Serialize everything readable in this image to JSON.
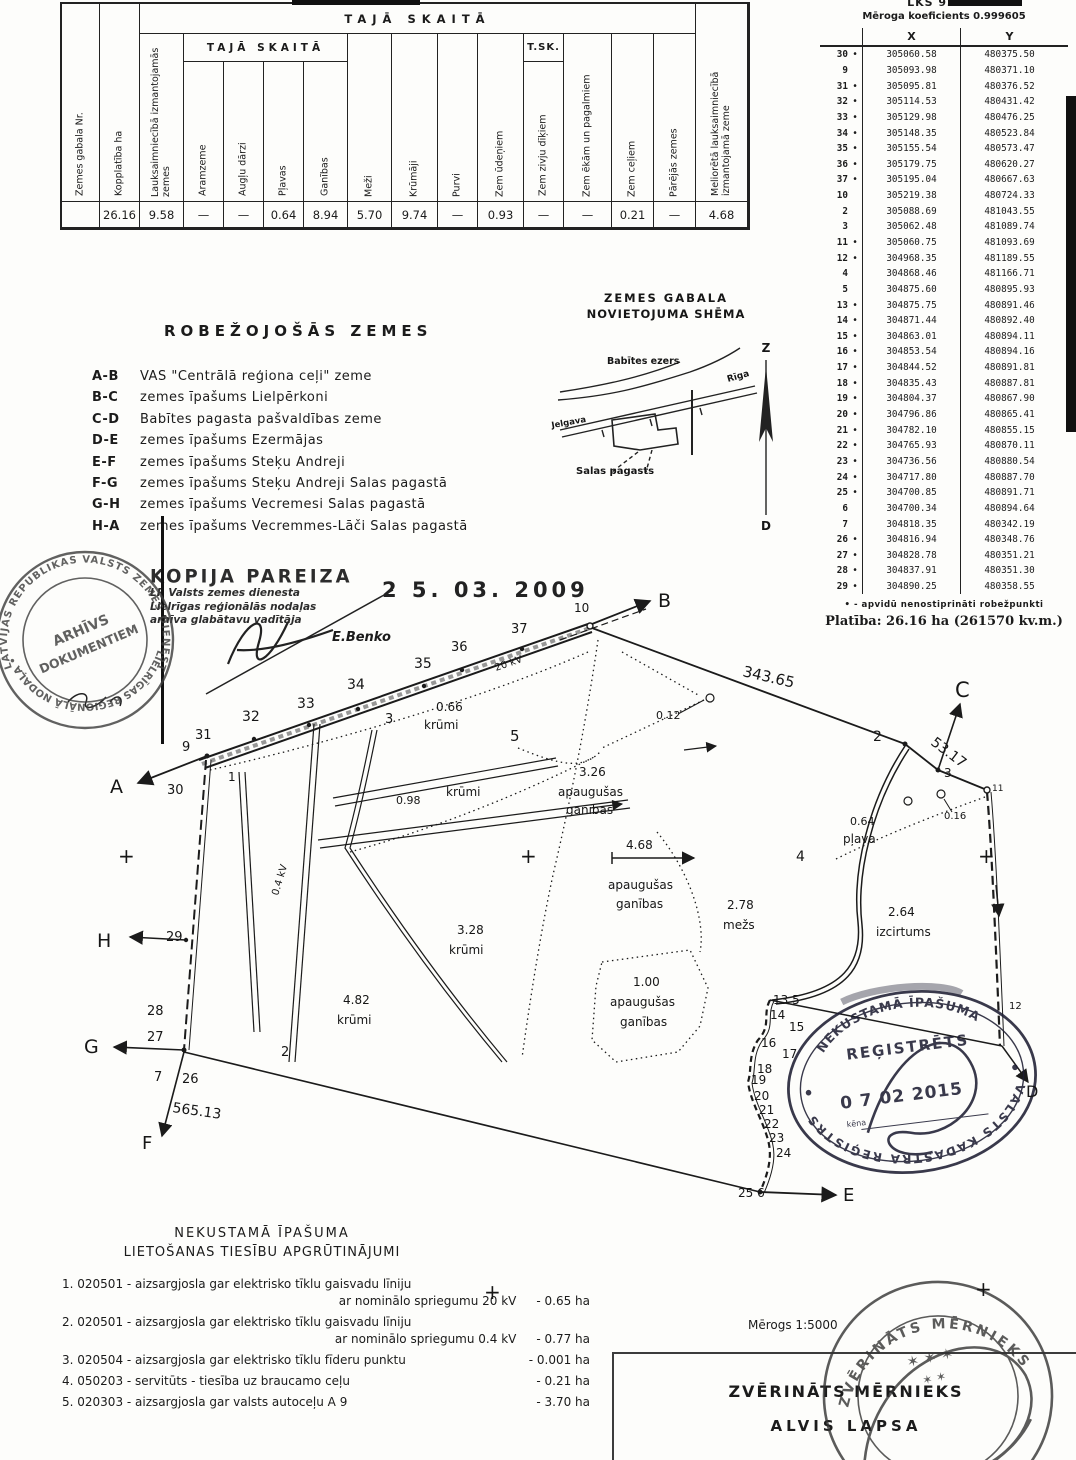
{
  "landuse_table": {
    "group1": "TAJĀ SKAITĀ",
    "group2": "TAJĀ SKAITĀ",
    "group3": "T.SK.",
    "columns": [
      "Zemes gabala Nr.",
      "Kopplatība ha",
      "Lauksaimniecībā izmantojamās zemes",
      "Aramzeme",
      "Augļu dārzi",
      "Pļavas",
      "Ganības",
      "Meži",
      "Krūmāji",
      "Purvi",
      "Zem ūdeņiem",
      "Zem zivju dīķiem",
      "Zem ēkām un pagalmiem",
      "Zem ceļiem",
      "Pārējās zemes",
      "Meliorētā lauksaimniecībā izmantojamā zeme"
    ],
    "values": [
      "",
      "26.16",
      "9.58",
      "—",
      "—",
      "0.64",
      "8.94",
      "5.70",
      "9.74",
      "—",
      "0.93",
      "—",
      "—",
      "0.21",
      "—",
      "4.68"
    ]
  },
  "coord_table": {
    "system": "LKS 92 TM",
    "scale_note": "Mēroga koeficients 0.999605",
    "col_x": "X",
    "col_y": "Y",
    "rows": [
      [
        "30",
        "•",
        "305060.58",
        "480375.50"
      ],
      [
        "9",
        "",
        "305093.98",
        "480371.10"
      ],
      [
        "31",
        "•",
        "305095.81",
        "480376.52"
      ],
      [
        "32",
        "•",
        "305114.53",
        "480431.42"
      ],
      [
        "33",
        "•",
        "305129.98",
        "480476.25"
      ],
      [
        "34",
        "•",
        "305148.35",
        "480523.84"
      ],
      [
        "35",
        "•",
        "305155.54",
        "480573.47"
      ],
      [
        "36",
        "•",
        "305179.75",
        "480620.27"
      ],
      [
        "37",
        "•",
        "305195.04",
        "480667.63"
      ],
      [
        "10",
        "",
        "305219.38",
        "480724.33"
      ],
      [
        "2",
        "",
        "305088.69",
        "481043.55"
      ],
      [
        "3",
        "",
        "305062.48",
        "481089.74"
      ],
      [
        "11",
        "•",
        "305060.75",
        "481093.69"
      ],
      [
        "12",
        "•",
        "304968.35",
        "481189.55"
      ],
      [
        "4",
        "",
        "304868.46",
        "481166.71"
      ],
      [
        "5",
        "",
        "304875.60",
        "480895.93"
      ],
      [
        "13",
        "•",
        "304875.75",
        "480891.46"
      ],
      [
        "14",
        "•",
        "304871.44",
        "480892.40"
      ],
      [
        "15",
        "•",
        "304863.01",
        "480894.11"
      ],
      [
        "16",
        "•",
        "304853.54",
        "480894.16"
      ],
      [
        "17",
        "•",
        "304844.52",
        "480891.81"
      ],
      [
        "18",
        "•",
        "304835.43",
        "480887.81"
      ],
      [
        "19",
        "•",
        "304804.37",
        "480867.90"
      ],
      [
        "20",
        "•",
        "304796.86",
        "480865.41"
      ],
      [
        "21",
        "•",
        "304782.10",
        "480855.15"
      ],
      [
        "22",
        "•",
        "304765.93",
        "480870.11"
      ],
      [
        "23",
        "•",
        "304736.56",
        "480880.54"
      ],
      [
        "24",
        "•",
        "304717.80",
        "480887.70"
      ],
      [
        "25",
        "•",
        "304700.85",
        "480891.71"
      ],
      [
        "6",
        "",
        "304700.34",
        "480894.64"
      ],
      [
        "7",
        "",
        "304818.35",
        "480342.19"
      ],
      [
        "26",
        "•",
        "304816.94",
        "480348.76"
      ],
      [
        "27",
        "•",
        "304828.78",
        "480351.21"
      ],
      [
        "28",
        "•",
        "304837.91",
        "480351.30"
      ],
      [
        "29",
        "•",
        "304890.25",
        "480358.55"
      ]
    ],
    "footnote": "• - apvidū nenostiprināti robežpunkti",
    "area_line": "Platība: 26.16 ha (261570 kv.m.)"
  },
  "bordering": {
    "title": "ROBEŽOJOŠĀS ZEMES",
    "items": [
      {
        "seg": "A-B",
        "desc": "VAS \"Centrālā reģiona ceļi\" zeme"
      },
      {
        "seg": "B-C",
        "desc": "zemes īpašums Lielpērkoni"
      },
      {
        "seg": "C-D",
        "desc": "Babītes pagasta pašvaldības zeme"
      },
      {
        "seg": "D-E",
        "desc": "zemes īpašums Ezermājas"
      },
      {
        "seg": "E-F",
        "desc": "zemes īpašums Steķu Andreji"
      },
      {
        "seg": "F-G",
        "desc": "zemes īpašums Steķu Andreji Salas pagastā"
      },
      {
        "seg": "G-H",
        "desc": "zemes īpašums Vecremesi Salas pagastā"
      },
      {
        "seg": "H-A",
        "desc": "zemes īpašums Vecremmes-Lāči Salas pagastā"
      }
    ]
  },
  "sketch": {
    "title1": "ZEMES GABALA",
    "title2": "NOVIETOJUMA SHĒMA",
    "lake": "Babītes ezers",
    "road_left": "Jelgava",
    "road_right": "Rīga",
    "parish": "Salas pagasts",
    "north": "Z",
    "south": "D"
  },
  "copy_stamp": {
    "title": "KOPIJA PAREIZA",
    "line1": "LR Valsts zemes dienesta",
    "line2": "Lielrīgas reģionālās nodaļas",
    "line3": "arhīva glabātavu vadītāja",
    "date": "2 5. 03. 2009",
    "name": "E.Benko"
  },
  "archive_stamp": {
    "ring_top": "LATVIJAS REPUBLIKAS VALSTS ZEMES DIENESTS",
    "ring_bottom": "• LIELRĪGAS REĢIONĀLĀ NODAĻA •",
    "line1": "ARHĪVS",
    "line2": "DOKUMENTIEM"
  },
  "registry_stamp": {
    "arc_top": "NEKUSTAMĀ ĪPAŠUMA",
    "title": "REĢISTRĒTS",
    "date": "0 7  02  2015",
    "field": "kēna",
    "arc_bottom": "VALSTS KADASTRA REĢISTRS"
  },
  "surveyor_stamp": {
    "arc_top": "ZVĒRINĀTS MĒRNIEKS",
    "stars": "✶ ✶ ✶",
    "stars2": "✶   ✶"
  },
  "encumbrances": {
    "title1": "NEKUSTAMĀ ĪPAŠUMA",
    "title2": "LIETOŠANAS TIESĪBU APGRŪTINĀJUMI",
    "items": [
      {
        "num": "1.",
        "code": "020501",
        "text": "aizsargjosla gar elektrisko tīklu gaisvadu līniju",
        "text2": "ar nominālo spriegumu 20 kV",
        "area": "0.65 ha"
      },
      {
        "num": "2.",
        "code": "020501",
        "text": "aizsargjosla gar elektrisko tīklu gaisvadu līniju",
        "text2": "ar nominālo spriegumu 0.4 kV",
        "area": "0.77 ha"
      },
      {
        "num": "3.",
        "code": "020504",
        "text": "aizsargjosla gar elektrisko tīklu fīderu punktu",
        "area": "0.001 ha"
      },
      {
        "num": "4.",
        "code": "050203",
        "text": "servitūts - tiesība uz braucamo ceļu",
        "area": "0.21 ha"
      },
      {
        "num": "5.",
        "code": "020303",
        "text": "aizsargjosla gar valsts autoceļu A 9",
        "area": "3.70 ha"
      }
    ]
  },
  "footer": {
    "scale": "Mērogs 1:5000",
    "title": "ZVĒRINĀTS MĒRNIEKS",
    "name": "ALVIS LAPSA"
  },
  "map": {
    "labels": [
      {
        "t": "A",
        "x": 110,
        "y": 793,
        "fs": 19,
        "sf": 1
      },
      {
        "t": "B",
        "x": 658,
        "y": 607,
        "fs": 19,
        "sf": 1
      },
      {
        "t": "C",
        "x": 955,
        "y": 697,
        "fs": 21,
        "sf": 1
      },
      {
        "t": "D",
        "x": 1026,
        "y": 1097,
        "fs": 16,
        "sf": 1
      },
      {
        "t": "E",
        "x": 843,
        "y": 1201,
        "fs": 18,
        "sf": 1
      },
      {
        "t": "F",
        "x": 142,
        "y": 1149,
        "fs": 18,
        "sf": 1
      },
      {
        "t": "G",
        "x": 84,
        "y": 1053,
        "fs": 19,
        "sf": 1
      },
      {
        "t": "H",
        "x": 97,
        "y": 947,
        "fs": 19,
        "sf": 1
      },
      {
        "t": "30",
        "x": 167,
        "y": 794,
        "fs": 13
      },
      {
        "t": "9",
        "x": 182,
        "y": 751,
        "fs": 13
      },
      {
        "t": "31",
        "x": 195,
        "y": 739,
        "fs": 13
      },
      {
        "t": "1",
        "x": 228,
        "y": 781,
        "fs": 12
      },
      {
        "t": "32",
        "x": 242,
        "y": 721,
        "fs": 14
      },
      {
        "t": "33",
        "x": 297,
        "y": 708,
        "fs": 14
      },
      {
        "t": "34",
        "x": 347,
        "y": 689,
        "fs": 14
      },
      {
        "t": "35",
        "x": 414,
        "y": 668,
        "fs": 14
      },
      {
        "t": "36",
        "x": 451,
        "y": 651,
        "fs": 13
      },
      {
        "t": "37",
        "x": 511,
        "y": 633,
        "fs": 13
      },
      {
        "t": "10",
        "x": 574,
        "y": 612,
        "fs": 12
      },
      {
        "t": "3",
        "x": 385,
        "y": 723,
        "fs": 13
      },
      {
        "t": "5",
        "x": 510,
        "y": 741,
        "fs": 15
      },
      {
        "t": "2",
        "x": 873,
        "y": 741,
        "fs": 14
      },
      {
        "t": "3",
        "x": 944,
        "y": 777,
        "fs": 12
      },
      {
        "t": "11",
        "x": 992,
        "y": 791,
        "fs": 9
      },
      {
        "t": "12",
        "x": 1009,
        "y": 1009,
        "fs": 10
      },
      {
        "t": "4",
        "x": 796,
        "y": 861,
        "fs": 14
      },
      {
        "t": "2",
        "x": 281,
        "y": 1056,
        "fs": 13
      },
      {
        "t": "13 5",
        "x": 773,
        "y": 1004,
        "fs": 12
      },
      {
        "t": "14",
        "x": 770,
        "y": 1019,
        "fs": 12
      },
      {
        "t": "15",
        "x": 789,
        "y": 1031,
        "fs": 12
      },
      {
        "t": "16",
        "x": 761,
        "y": 1047,
        "fs": 12
      },
      {
        "t": "17",
        "x": 782,
        "y": 1058,
        "fs": 12
      },
      {
        "t": "18",
        "x": 757,
        "y": 1073,
        "fs": 12
      },
      {
        "t": "19",
        "x": 751,
        "y": 1084,
        "fs": 12
      },
      {
        "t": "20",
        "x": 754,
        "y": 1100,
        "fs": 12
      },
      {
        "t": "21",
        "x": 759,
        "y": 1114,
        "fs": 12
      },
      {
        "t": "22",
        "x": 764,
        "y": 1128,
        "fs": 12
      },
      {
        "t": "23",
        "x": 769,
        "y": 1142,
        "fs": 12
      },
      {
        "t": "24",
        "x": 776,
        "y": 1157,
        "fs": 12
      },
      {
        "t": "25 6",
        "x": 738,
        "y": 1197,
        "fs": 12
      },
      {
        "t": "29",
        "x": 166,
        "y": 941,
        "fs": 13
      },
      {
        "t": "28",
        "x": 147,
        "y": 1015,
        "fs": 13
      },
      {
        "t": "27",
        "x": 147,
        "y": 1041,
        "fs": 13
      },
      {
        "t": "7",
        "x": 154,
        "y": 1081,
        "fs": 13
      },
      {
        "t": "26",
        "x": 182,
        "y": 1083,
        "fs": 13
      },
      {
        "t": "343.65",
        "x": 742,
        "y": 676,
        "fs": 15,
        "r": 13
      },
      {
        "t": "53.17",
        "x": 930,
        "y": 744,
        "fs": 14,
        "r": 37
      },
      {
        "t": "565.13",
        "x": 172,
        "y": 1112,
        "fs": 14,
        "r": 8
      },
      {
        "t": "0.66",
        "x": 436,
        "y": 711,
        "fs": 12
      },
      {
        "t": "krūmi",
        "x": 424,
        "y": 729,
        "fs": 12
      },
      {
        "t": "0.98",
        "x": 396,
        "y": 804,
        "fs": 11
      },
      {
        "t": "krūmi",
        "x": 446,
        "y": 796,
        "fs": 12
      },
      {
        "t": "0.12",
        "x": 656,
        "y": 719,
        "fs": 11
      },
      {
        "t": "0.16",
        "x": 944,
        "y": 819,
        "fs": 10
      },
      {
        "t": "0.64",
        "x": 850,
        "y": 825,
        "fs": 11
      },
      {
        "t": "pļava",
        "x": 843,
        "y": 843,
        "fs": 12
      },
      {
        "t": "3.26",
        "x": 579,
        "y": 776,
        "fs": 12
      },
      {
        "t": "apaugušas",
        "x": 558,
        "y": 796,
        "fs": 12
      },
      {
        "t": "ganības",
        "x": 566,
        "y": 814,
        "fs": 12
      },
      {
        "t": "4.68",
        "x": 626,
        "y": 849,
        "fs": 12
      },
      {
        "t": "apaugušas",
        "x": 608,
        "y": 889,
        "fs": 12
      },
      {
        "t": "ganības",
        "x": 616,
        "y": 908,
        "fs": 12
      },
      {
        "t": "2.78",
        "x": 727,
        "y": 909,
        "fs": 12
      },
      {
        "t": "mežs",
        "x": 723,
        "y": 929,
        "fs": 12
      },
      {
        "t": "2.64",
        "x": 888,
        "y": 916,
        "fs": 12
      },
      {
        "t": "izcirtums",
        "x": 876,
        "y": 936,
        "fs": 12
      },
      {
        "t": "3.28",
        "x": 457,
        "y": 934,
        "fs": 12
      },
      {
        "t": "krūmi",
        "x": 449,
        "y": 954,
        "fs": 12
      },
      {
        "t": "1.00",
        "x": 633,
        "y": 986,
        "fs": 12
      },
      {
        "t": "apaugušas",
        "x": 610,
        "y": 1006,
        "fs": 12
      },
      {
        "t": "ganības",
        "x": 620,
        "y": 1026,
        "fs": 12
      },
      {
        "t": "4.82",
        "x": 343,
        "y": 1004,
        "fs": 12
      },
      {
        "t": "krūmi",
        "x": 337,
        "y": 1024,
        "fs": 12
      },
      {
        "t": "20 kV",
        "x": 496,
        "y": 671,
        "fs": 10,
        "r": -19
      },
      {
        "t": "0.4 kV",
        "x": 278,
        "y": 896,
        "fs": 10,
        "r": -73
      },
      {
        "t": "+",
        "x": 118,
        "y": 863,
        "fs": 20
      },
      {
        "t": "+",
        "x": 520,
        "y": 863,
        "fs": 20
      },
      {
        "t": "+",
        "x": 978,
        "y": 863,
        "fs": 20
      },
      {
        "t": "+",
        "x": 484,
        "y": 1299,
        "fs": 20
      },
      {
        "t": "+",
        "x": 975,
        "y": 1296,
        "fs": 20
      }
    ]
  }
}
